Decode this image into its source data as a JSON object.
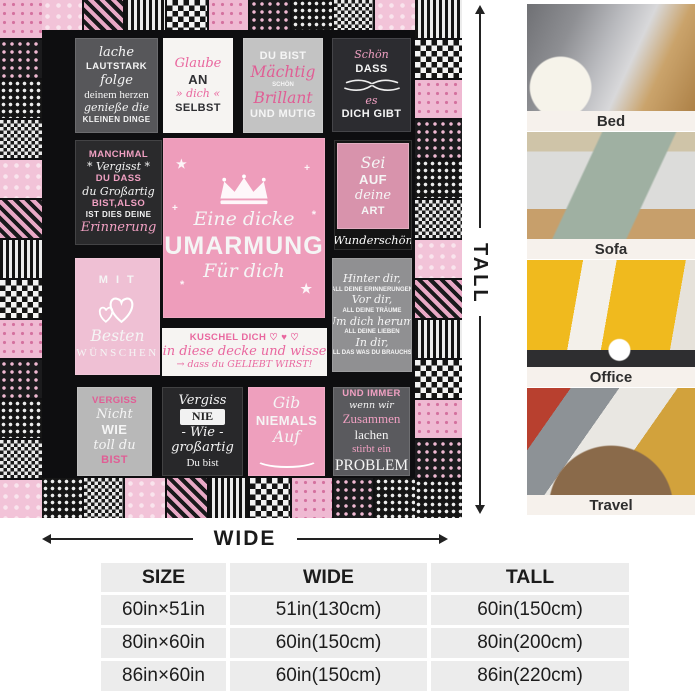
{
  "blanket": {
    "panels": {
      "p1": {
        "lines": [
          [
            "lache",
            "scr lg"
          ],
          [
            "LAUTSTARK",
            "cap sm"
          ],
          [
            "folge",
            "scr lg"
          ],
          [
            "deinem herzen",
            "ser md"
          ],
          [
            "genieße die",
            "scr md"
          ],
          [
            "KLEINEN DINGE",
            "cap xs"
          ]
        ]
      },
      "p2": {
        "lines": [
          [
            "Glaube",
            "scr lg pk"
          ],
          [
            "AN",
            "cap lg"
          ],
          [
            "» dich «",
            "scr md pk"
          ],
          [
            "SELBST",
            "cap md"
          ]
        ]
      },
      "p3": {
        "lines": [
          [
            "DU BIST",
            "cap md"
          ],
          [
            "Mächtig",
            "scr xl pk"
          ],
          [
            "SCHÖN",
            "cap xxs"
          ],
          [
            "Brillant",
            "scr xl pk"
          ],
          [
            "UND MUTIG",
            "cap md"
          ]
        ]
      },
      "p4": {
        "lines": [
          [
            "Schön",
            "scr md pk"
          ],
          [
            "DASS",
            "cap md"
          ]
        ],
        "lines2": [
          [
            "es",
            "scr md pk"
          ],
          [
            "DICH GIBT",
            "cap md"
          ]
        ]
      },
      "p5": {
        "lines": [
          [
            "MANCHMAL",
            "cap sm pk"
          ],
          [
            "* Vergisst *",
            "scr md"
          ],
          [
            "DU DASS",
            "cap sm pk"
          ],
          [
            "du Großartig",
            "scr md"
          ],
          [
            "BIST,ALSO",
            "cap sm pk"
          ],
          [
            "IST DIES DEINE",
            "cap xs"
          ],
          [
            "Erinnerung",
            "scr lg pk"
          ]
        ]
      },
      "p6": {
        "lines": [
          [
            "Eine dicke",
            "scr xl2"
          ],
          [
            "UMARMUNG",
            "cap xxl"
          ],
          [
            "Für dich",
            "scr xl2"
          ]
        ]
      },
      "p7": {
        "lines": [
          [
            "Sei",
            "scr xl"
          ],
          [
            "AUF",
            "cap lg"
          ],
          [
            "deine",
            "scr lg"
          ],
          [
            "ART",
            "cap md"
          ]
        ],
        "caption": "Wunderschön"
      },
      "p8": {
        "lines": [
          [
            "M I T",
            "cap md sp"
          ]
        ],
        "lines2": [
          [
            "Besten",
            "scr xl"
          ],
          [
            "WÜNSCHEN",
            "ser md sp"
          ]
        ]
      },
      "p9": {
        "lines": [
          [
            "Hinter dir,",
            "scr md"
          ],
          [
            "ALL DEINE ERINNERUNGEN",
            "cap xxs"
          ],
          [
            "Vor dir,",
            "scr md"
          ],
          [
            "ALL DEINE TRÄUME",
            "cap xxs"
          ],
          [
            "Um dich herum,",
            "scr md"
          ],
          [
            "ALL DEINE LIEBEN",
            "cap xxs"
          ],
          [
            "In dir,",
            "scr md"
          ],
          [
            "ALL DAS WAS DU BRAUCHST",
            "cap xxs"
          ]
        ]
      },
      "p10": {
        "lines": [
          [
            "KUSCHEL DICH ♡ ♥ ♡",
            "cap sm pk"
          ],
          [
            "in diese decke und wisse",
            "scr lg pk"
          ],
          [
            "→ dass du GELIEBT WIRST!",
            "scr sm pk"
          ]
        ]
      },
      "p11": {
        "lines": [
          [
            "VERGISS",
            "cap sm pk"
          ],
          [
            "Nicht",
            "scr lg"
          ],
          [
            "WIE",
            "cap lg"
          ],
          [
            "toll du",
            "scr lg"
          ],
          [
            "BIST",
            "cap md pk"
          ]
        ]
      },
      "p12": {
        "lines": [
          [
            "Vergiss",
            "scr lg"
          ],
          [
            "NIE",
            "banner"
          ],
          [
            "- Wie -",
            "scr lg"
          ],
          [
            "großartig",
            "scr lg"
          ],
          [
            "Du bist",
            "ser md"
          ]
        ]
      },
      "p13": {
        "lines": [
          [
            "Gib",
            "scr xl"
          ],
          [
            "NIEMALS",
            "cap lg"
          ],
          [
            "Auf",
            "scr xl"
          ]
        ]
      },
      "p14": {
        "lines": [
          [
            "UND IMMER",
            "cap sm pk"
          ],
          [
            "wenn wir",
            "scr sm"
          ],
          [
            "Zusammen",
            "ser lg pk"
          ],
          [
            "lachen",
            "ser lg"
          ],
          [
            "stirbt ein",
            "ser md pk"
          ],
          [
            "PROBLEM",
            "ser xl"
          ]
        ]
      }
    }
  },
  "dimensions": {
    "tall": "TALL",
    "wide": "WIDE"
  },
  "photos": [
    {
      "label": "Bed"
    },
    {
      "label": "Sofa"
    },
    {
      "label": "Office"
    },
    {
      "label": "Travel"
    }
  ],
  "size_table": {
    "headers": [
      "SIZE",
      "WIDE",
      "TALL"
    ],
    "rows": [
      [
        "60in×51in",
        "51in(130cm)",
        "60in(150cm)"
      ],
      [
        "80in×60in",
        "60in(150cm)",
        "80in(200cm)"
      ],
      [
        "86in×60in",
        "60in(150cm)",
        "86in(220cm)"
      ]
    ]
  },
  "colors": {
    "pink_main": "#ee9dbb",
    "pink_light": "#efc0d4",
    "pink_text": "#e9679f",
    "quilt_black": "#101012",
    "gray_panel": "#c3c3c3",
    "table_cell": "#ececec"
  }
}
